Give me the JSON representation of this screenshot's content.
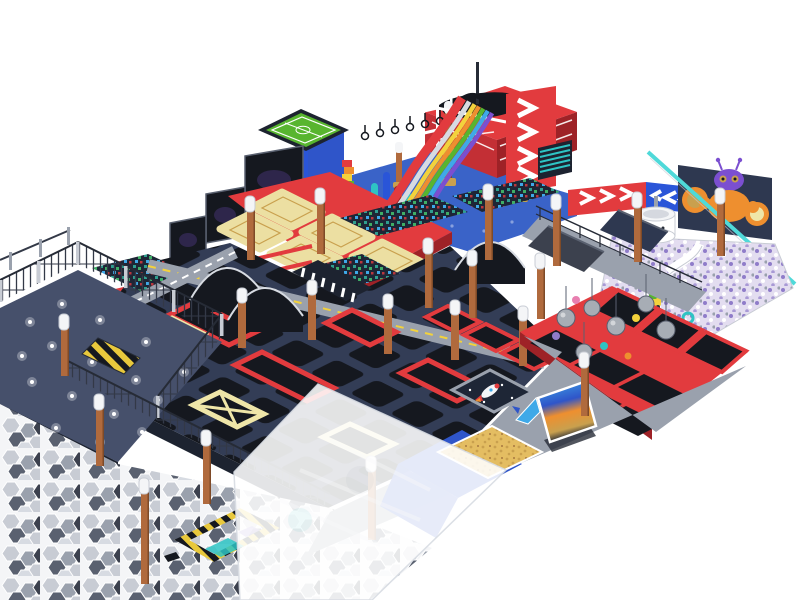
{
  "meta": {
    "title": "3D isometric render of an indoor trampoline park with trampoline grid, rainbow slide, pirate ship, ninja course, foam pits, wrecking-ball zone, LED star platform and kids soft-play ball pit",
    "type": "architectural-render",
    "background": "#ffffff"
  },
  "palette": {
    "white": "#ffffff",
    "offWhite": "#f4f5f7",
    "silver": "#d7dbe2",
    "lightGray": "#c8ccd4",
    "steel": "#9aa1ad",
    "slate": "#5a6170",
    "darkGray": "#3c414e",
    "charcoal": "#262b36",
    "black": "#15181f",
    "navy": "#2e3850",
    "fieldNavy": "#333d56",
    "pitNavy": "#1e2636",
    "deepNavy": "#1d2330",
    "starSlate": "#46506b",
    "fence": "#333947",
    "red": "#e23b3e",
    "wineRed": "#c32f35",
    "darkRed": "#9e2227",
    "yellow": "#f3d23c",
    "paleYellow": "#efe6a8",
    "tan": "#ecdfa2",
    "gold": "#c9a04e",
    "sand": "#e4bd62",
    "orange": "#ee8f2f",
    "green": "#58b52f",
    "teal": "#2ec4c4",
    "tealWall": "#4fd9d9",
    "foamTeal": "#2f9e8f",
    "foamGreen": "#3fae66",
    "skyBlue": "#3fa9e8",
    "royal": "#2f55c9",
    "blueFloor": "#3a63c8",
    "blue": "#2a55d8",
    "purple": "#7b4fd0",
    "orchid": "#8f7cc9",
    "lavender": "#e3ddf0",
    "wood": "#b06a3d",
    "woodDark": "#7e4a28",
    "ballGray": "#a7adb5",
    "hazYellow": "#e8c83c",
    "pink": "#e87fb0"
  },
  "zones": {
    "scene": {
      "label": "indoor trampoline park overview render"
    },
    "soccer": {
      "label": "elevated mini soccer field platform"
    },
    "pirate": {
      "label": "pirate ship themed platform"
    },
    "slide": {
      "label": "rainbow wave slide"
    },
    "tower": {
      "label": "red slide tower with white chevron arrows"
    },
    "ninja": {
      "label": "ninja hanging-rings course"
    },
    "signs": {
      "label": "red and blue chevron direction signs"
    },
    "robot": {
      "label": "kids soft-play zone with robot figure"
    },
    "ballpit": {
      "label": "ball pit with purple and white balls"
    },
    "teacup": {
      "label": "white teacup ride"
    },
    "screens": {
      "label": "dark projection screens"
    },
    "protramp": {
      "label": "performance trampolines with tan beds"
    },
    "walkway": {
      "label": "upper walkway with railing and ramps"
    },
    "grid": {
      "label": "main trampoline grid with black mats"
    },
    "foam": {
      "label": "foam cube pits"
    },
    "wreck": {
      "label": "wrecking-ball trampoline zone"
    },
    "stars": {
      "label": "LED starlight platform with mesh fence"
    },
    "hex": {
      "label": "hexagon tile floor"
    },
    "canopy": {
      "label": "translucent white canopy sheet"
    },
    "apron": {
      "label": "gray walkway apron"
    },
    "sandpit": {
      "label": "golden sand pit"
    },
    "screen": {
      "label": "interactive game projection screen"
    },
    "space": {
      "label": "space themed trampoline with rocket"
    },
    "carpet": {
      "label": "blue carpet"
    },
    "pillars": {
      "label": "wooden support pillars with white caps"
    },
    "hazard": {
      "label": "yellow-black hazard striped elements"
    }
  }
}
